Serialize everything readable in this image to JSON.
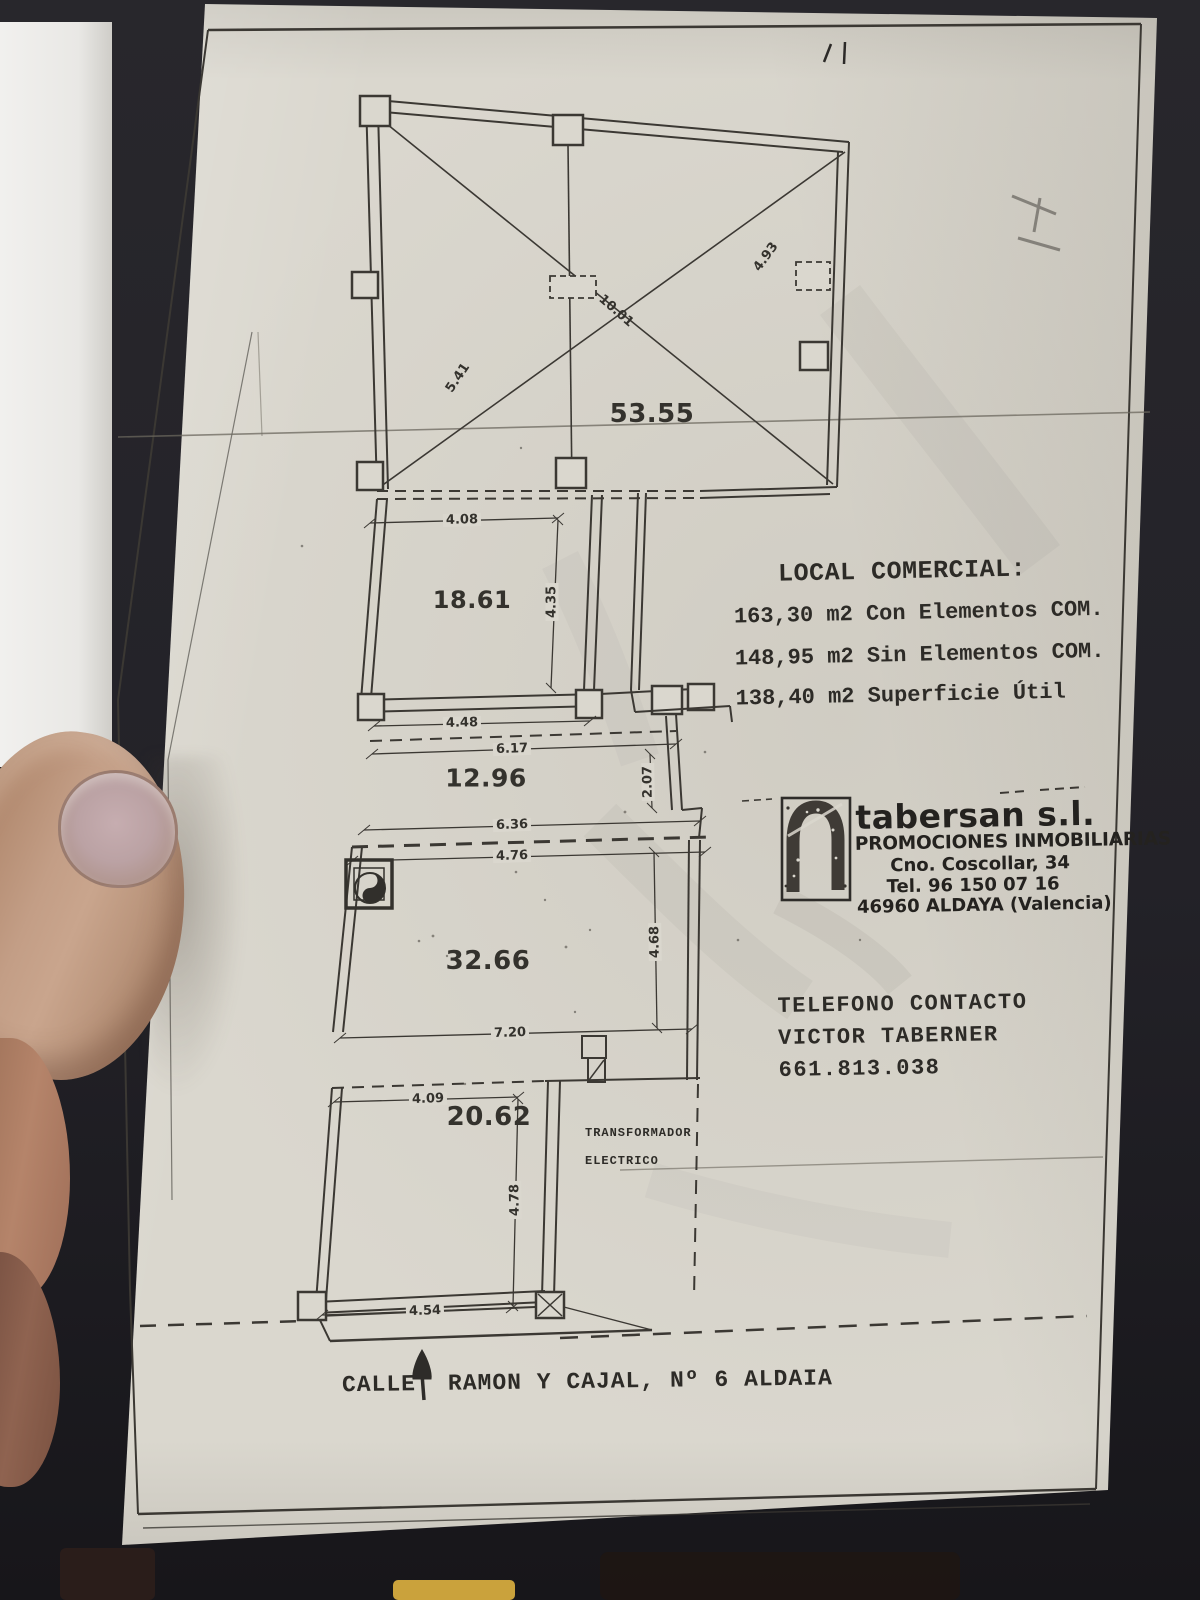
{
  "plan": {
    "areas": {
      "hall": "53.55",
      "room_a": "18.61",
      "room_b": "12.96",
      "room_c": "32.66",
      "room_d": "20.62"
    },
    "dims": {
      "v408": "4.08",
      "v435": "4.35",
      "v448": "4.48",
      "v617": "6.17",
      "v207": "2.07",
      "v636": "6.36",
      "v476": "4.76",
      "v468": "4.68",
      "v720": "7.20",
      "v409": "4.09",
      "v478": "4.78",
      "v454": "4.54",
      "v541": "5.41",
      "v1001": "10.01",
      "v493": "4.93"
    },
    "transformer": {
      "line1": "TRANSFORMADOR",
      "line2": "ELECTRICO"
    }
  },
  "info": {
    "title": "LOCAL COMERCIAL:",
    "lines": [
      "163,30 m2 Con Elementos COM.",
      "148,95 m2 Sin Elementos COM.",
      "138,40 m2 Superficie Útil"
    ]
  },
  "company": {
    "name": "tabersan s.l.",
    "tagline": "PROMOCIONES INMOBILIARIAS",
    "address": "Cno. Coscollar, 34",
    "phone": "Tel. 96 150 07 16",
    "city": "46960 ALDAYA (Valencia)"
  },
  "contact": {
    "heading": "TELEFONO CONTACTO",
    "name": "VICTOR TABERNER",
    "phone": "661.813.038"
  },
  "street": {
    "prefix": "CALLE",
    "suffix": "RAMON Y CAJAL, Nº 6 ALDAIA"
  },
  "colors": {
    "paper": "#dad7ce",
    "ink": "#3b3833",
    "tray_orange": "#d4681f"
  }
}
